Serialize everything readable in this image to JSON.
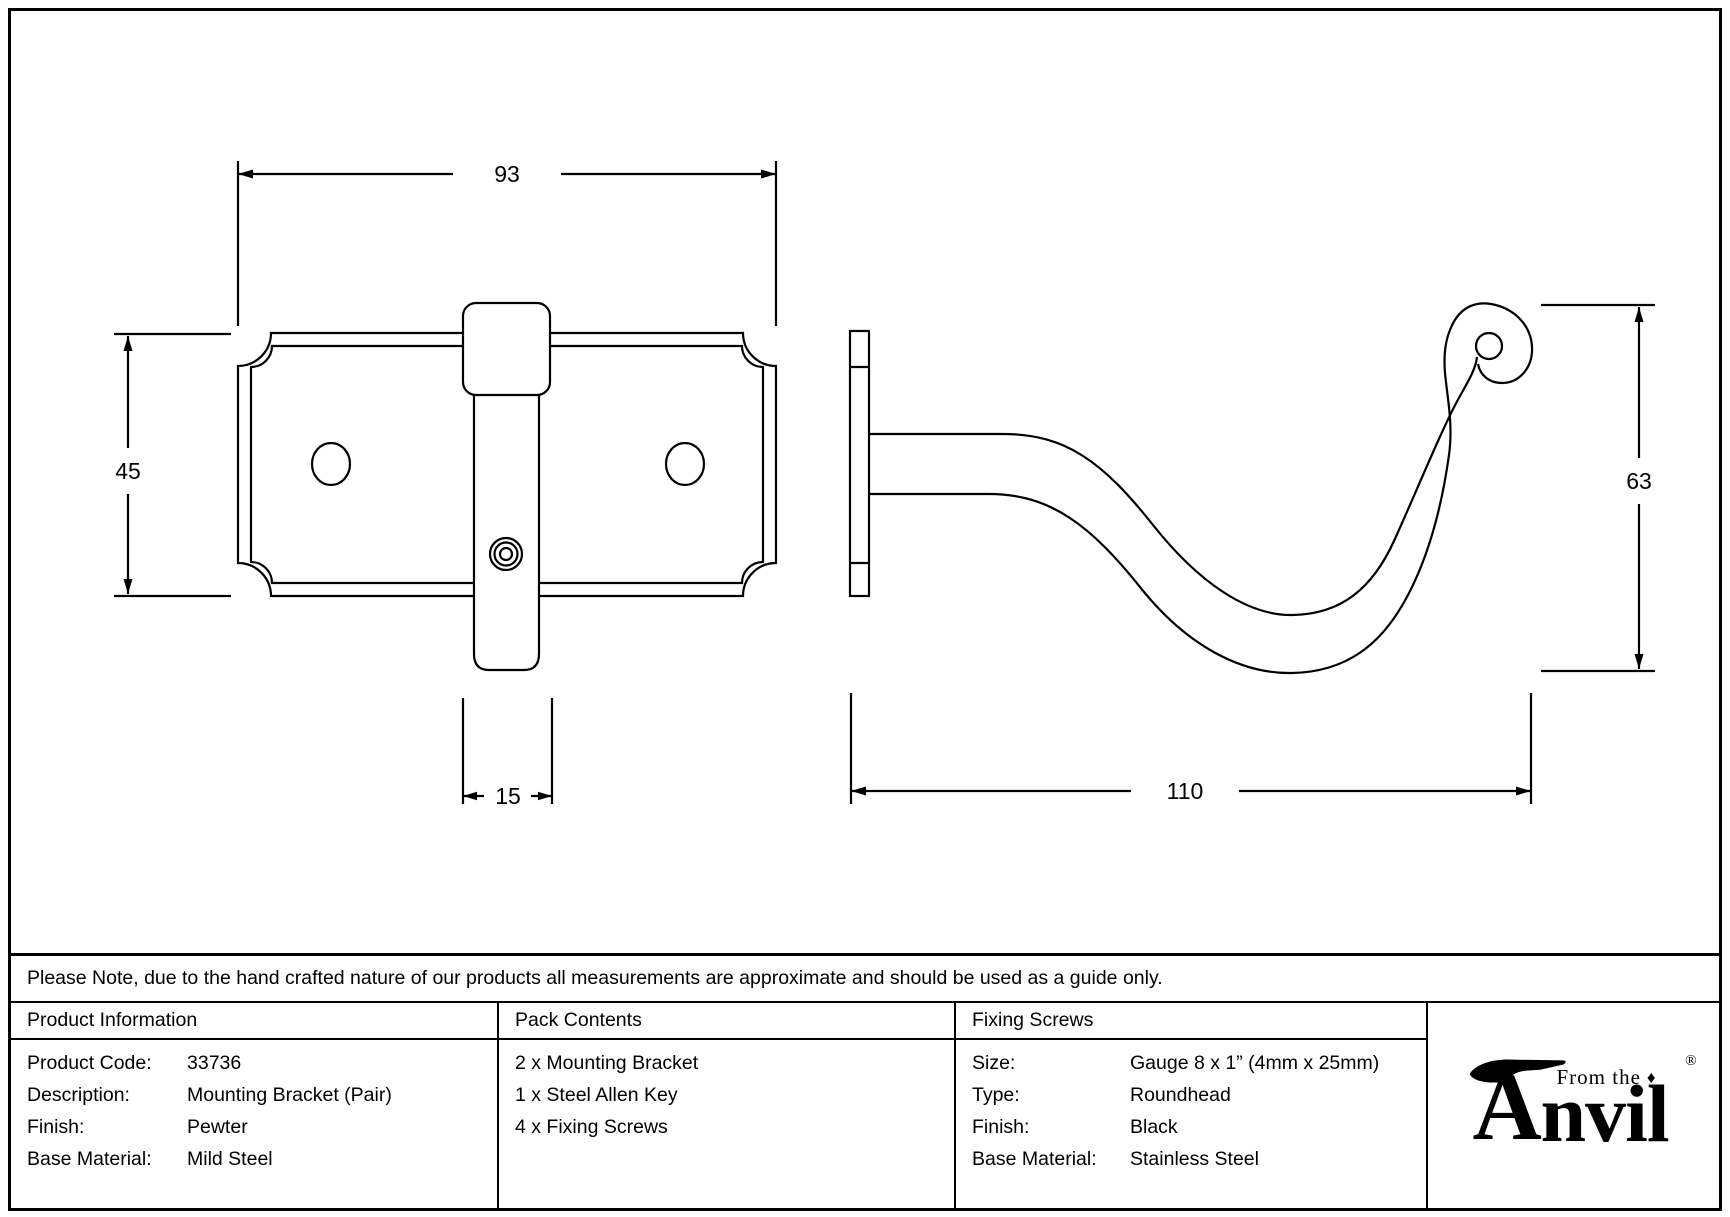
{
  "drawing": {
    "front": {
      "width_label": "93",
      "height_label": "45",
      "stem_width_label": "15"
    },
    "side": {
      "height_label": "63",
      "depth_label": "110"
    }
  },
  "note": "Please Note, due to the hand crafted nature of our products all measurements are approximate and should be used as a guide only.",
  "table": {
    "product_information": {
      "title": "Product Information",
      "rows": [
        {
          "label": "Product Code:",
          "value": "33736"
        },
        {
          "label": "Description:",
          "value": "Mounting Bracket (Pair)"
        },
        {
          "label": "Finish:",
          "value": "Pewter"
        },
        {
          "label": "Base Material:",
          "value": "Mild Steel"
        }
      ]
    },
    "pack_contents": {
      "title": "Pack Contents",
      "items": [
        "2 x Mounting Bracket",
        "1 x Steel Allen Key",
        "4 x Fixing Screws"
      ]
    },
    "fixing_screws": {
      "title": "Fixing Screws",
      "rows": [
        {
          "label": "Size:",
          "value": "Gauge 8 x 1” (4mm x 25mm)"
        },
        {
          "label": "Type:",
          "value": "Roundhead"
        },
        {
          "label": "Finish:",
          "value": "Black"
        },
        {
          "label": "Base Material:",
          "value": "Stainless Steel"
        }
      ]
    }
  },
  "logo": {
    "tagline": "From the",
    "diamond": "♦",
    "brand_a": "A",
    "brand_rest": "nvil",
    "registered": "®"
  }
}
